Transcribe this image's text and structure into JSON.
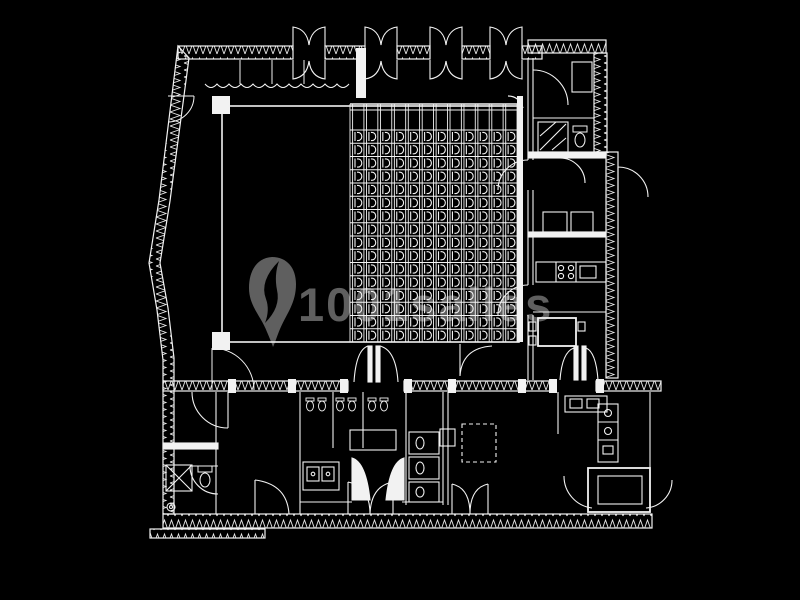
{
  "canvas": {
    "width": 800,
    "height": 600,
    "background": "#000000",
    "line_color": "#f2f2f2"
  },
  "watermark": {
    "text": "1001salles",
    "color": "#707070",
    "logo": "location-pin",
    "opacity": 0.85
  },
  "floor_plan": {
    "kind": "theater-floor-plan-white-cad-linework-on-black",
    "auditorium": {
      "seat_columns": 12,
      "seat_rows": 16,
      "seats_total": 192,
      "grid": {
        "x": 350,
        "y": 104,
        "right": 517,
        "bottom": 342,
        "seats_top": 130,
        "col_width": 13.92,
        "row_height": 13.25
      }
    }
  }
}
